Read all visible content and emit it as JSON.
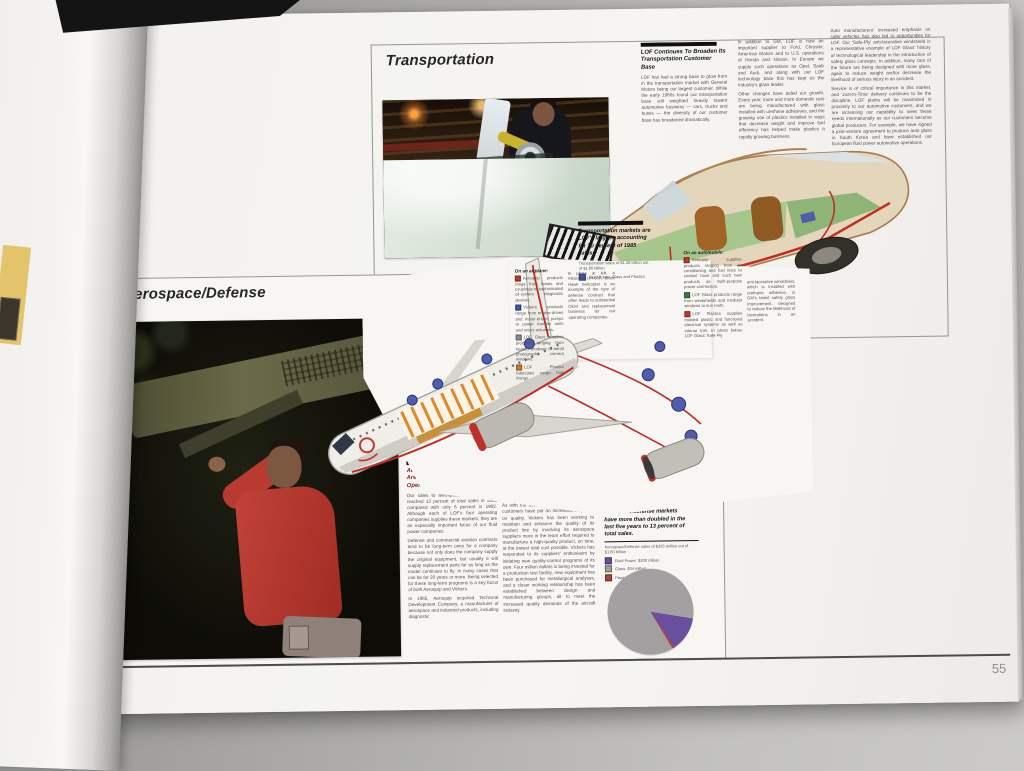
{
  "page": {
    "number": "55"
  },
  "transportation": {
    "title": "Transportation",
    "article": {
      "heading": "LOF Continues To Broaden Its Transportation Customer Base",
      "col1": [
        "LOF has had a strong base to grow from in the transportation market with General Motors being our largest customer. While the early 1980s found our transportation base still weighted heavily toward automotive business — cars, trucks and buses — the diversity of our customer base has broadened dramatically."
      ],
      "col2": [
        "In addition to GM, LOF is now an important supplier to Ford, Chrysler, American Motors and to U.S. operations of Honda and Nissan. In Europe we supply such operations as Opel, Saab and Audi, and along with our LOF technology base this has kept us the industry's glass leader.",
        "Other changes have aided our growth. Every year, more and more domestic cars are being manufactured with glass installed with urethane adhesives, and the growing use of plastics installed in ways that decrease weight and improve fuel efficiency has helped make plastics a rapidly growing business."
      ],
      "col3": [
        "Auto manufacturers' increased emphasis on safer vehicles has also led to opportunities for LOF. Our 'Safe-Ply' anti-lacerative windshield is a representative example of LOF Glass' history of technological leadership in the introduction of safety glass concepts. In addition, many cars of the future are being designed with more glass, again to reduce weight and/or decrease the likelihood of serious injury in an accident.",
        "Service is of critical importance in this market, and 'Just-In-Time' delivery continues to be the discipline. LOF plants will be maximized in proximity to our automotive customers, and we are increasing our capability to meet these needs internationally as our customers become global producers. For example, we have signed a joint-venture agreement to produce auto glass in South Korea and have established our European fluid power automotive operations."
      ]
    },
    "caption": {
      "lead": "Transportation markets are LOF's largest, accounting for 70 percent of 1985 sales.",
      "note": "Transportation sales of $1.26 billion out of $1.80 billion",
      "legend_label": "Fluid Power, Glass and Plastics",
      "legend_style": "background:#3a57a8"
    },
    "auto": {
      "heading": "On an automobile:",
      "items": [
        {
          "style": "background:#c0392b",
          "text": "Aeroquip supplies products ranging from air conditioning and fuel lines to coolant hose and such new products as multi-purpose power connectors."
        },
        {
          "style": "background:#3f7a3a",
          "text": "LOF Glass products range from windshields and modular windows to sun roofs."
        },
        {
          "style": "background:#c0392b",
          "text": "LOF Plastics supplies molded plastic and functional electrical systems as well as interior trim. In photo below, LOF Glass' Safe-Ply"
        }
      ],
      "continuation": "anti-lacerative windshield, which is installed with urethane adhesive, is GM's latest safety glass improvement, designed to reduce the likelihood of lacerations in an accident."
    }
  },
  "aerospace": {
    "title": "Aerospace/Defense",
    "airplane": {
      "heading": "On an airplane:",
      "items": [
        {
          "style": "background:#c0392b",
          "text": "Aeroquip products range from hoses and couplings to sophisticated oil-system diagnostic devices."
        },
        {
          "style": "background:#3a57a8",
          "text": "Vickers products range from engine-driven and motor-driven pumps to power transfer units and rotary actuators."
        },
        {
          "style": "background:#8d8d8b",
          "text": "LOF Glass supplies products ranging from heated windows to aerial photography camera windows."
        },
        {
          "style": "background:#d07a28",
          "text": "LOF Plastics fabricates cargo hold linings."
        }
      ],
      "photo_caption": "In photo at left, a Sikorsky UH-60A Black Hawk helicopter is an example of the type of defense contract that often leads to substantial OEM and replacement business for our operating companies."
    },
    "article": {
      "heading": "Aerospace/Defense Programs Are Key Focus of Fluid Power Operations",
      "col1": [
        "Our sales to aerospace/defense markets reached 13 percent of total sales in 1985 compared with only 6 percent in 1982. Although each of LOF's four operating companies supplies these markets, they are an especially important focus of our fluid power companies.",
        "Defense and commercial aviation contracts tend to be long-term ones for a company because not only does the company supply the original equipment, but usually it will supply replacement parts for as long as the model continues to fly. In many cases that can be for 20 years or more. Being selected for these long-term programs is a key focus of both Aeroquip and Vickers.",
        "In 1985, Aeroquip acquired Technical Development Company, a manufacturer of aerospace and industrial products, including diagnostic"
      ],
      "col2": [
        "devices for monitoring the condition of machinery lubrication systems, a critical need in planes and helicopters. Both Aeroquip and Vickers continue to improve their product offerings to their European aerospace customers.",
        "As with the automotive industry, aerospace customers have put an increased emphasis on quality. Vickers has been working to maintain and enhance the quality of its product line by involving its aerospace suppliers more in the team effort required to manufacture a high-quality product, on time, at the lowest total cost possible. Vickers has responded to its suppliers' enthusiasm by initiating new quality-control programs of its own. Four million dollars is being invested for a production test facility, new equipment has been purchased for metallurgical analyses, and a closer working relationship has been established between design and manufacturing groups, all to meet the increased quality demands of the aircraft industry."
      ]
    },
    "chart": {
      "caption": "LOF sales to aerospace/defense markets have more than doubled in the last five years to 13 percent of total sales.",
      "legend_title": "Aerospace/Defense sales of $235 million out of $1.80 billion",
      "legend": [
        {
          "label": "Fluid Power: $200 million",
          "style": "background:#6b4f9f"
        },
        {
          "label": "Glass: $34 million",
          "style": "background:#a3a0a2"
        },
        {
          "label": "Plastics: $1 million",
          "style": "background:#b0433a"
        }
      ]
    }
  },
  "chart_data": {
    "type": "pie",
    "title": "Aerospace/Defense sales of $235 million out of $1.80 billion",
    "slices": [
      {
        "label": "Aerospace/Defense (Fluid Power)",
        "pct": 13,
        "color": "#6b4f9f"
      },
      {
        "label": "Plastics sliver",
        "pct": 1,
        "color": "#b0433a"
      },
      {
        "label": "All other LOF sales",
        "pct": 86,
        "color": "#a3a0a2"
      }
    ],
    "legend_position": "above-left",
    "legend": [
      "Fluid Power: $200 million",
      "Glass: $34 million",
      "Plastics: $1 million"
    ]
  }
}
